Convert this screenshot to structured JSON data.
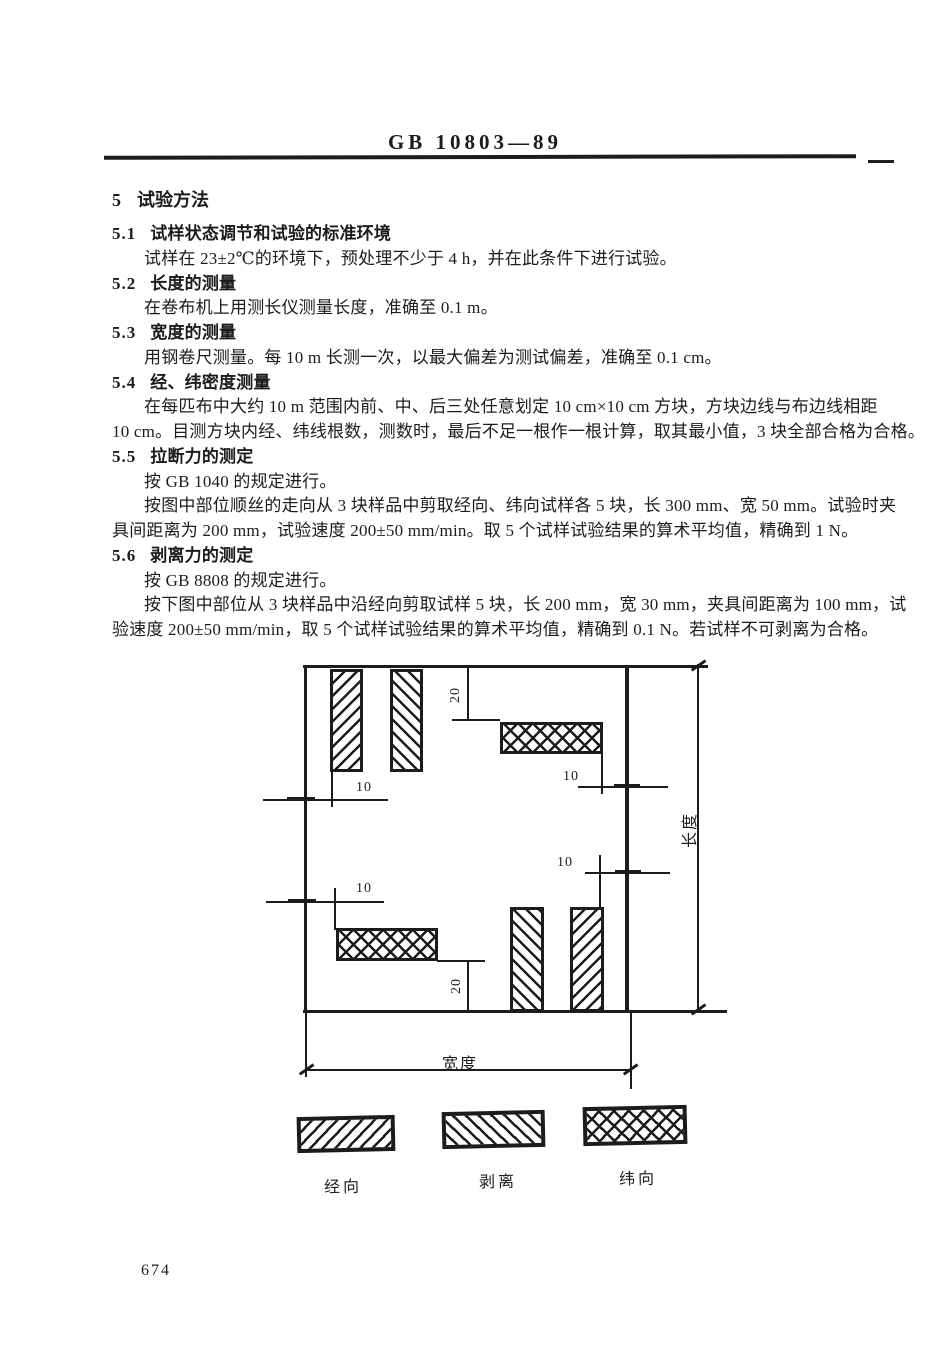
{
  "header": {
    "standard_code": "GB 10803—89"
  },
  "section": {
    "num": "5",
    "title": "试验方法"
  },
  "lines": [
    {
      "type": "clause",
      "num": "5.1",
      "title": "试样状态调节和试验的标准环境"
    },
    {
      "type": "para-first",
      "text": "试样在 23±2℃的环境下，预处理不少于 4 h，并在此条件下进行试验。"
    },
    {
      "type": "clause",
      "num": "5.2",
      "title": "长度的测量"
    },
    {
      "type": "para-first",
      "text": "在卷布机上用测长仪测量长度，准确至 0.1 m。"
    },
    {
      "type": "clause",
      "num": "5.3",
      "title": "宽度的测量"
    },
    {
      "type": "para-first",
      "text": "用钢卷尺测量。每 10 m 长测一次，以最大偏差为测试偏差，准确至 0.1 cm。"
    },
    {
      "type": "clause",
      "num": "5.4",
      "title": "经、纬密度测量"
    },
    {
      "type": "para-first",
      "text": "在每匹布中大约 10 m 范围内前、中、后三处任意划定 10 cm×10 cm 方块，方块边线与布边线相距"
    },
    {
      "type": "para-cont",
      "text": "10 cm。目测方块内经、纬线根数，测数时，最后不足一根作一根计算，取其最小值，3 块全部合格为合格。"
    },
    {
      "type": "clause",
      "num": "5.5",
      "title": "拉断力的测定"
    },
    {
      "type": "para-first",
      "text": "按 GB 1040 的规定进行。"
    },
    {
      "type": "para-first",
      "text": "按图中部位顺丝的走向从 3 块样品中剪取经向、纬向试样各 5 块，长 300 mm、宽 50 mm。试验时夹"
    },
    {
      "type": "para-cont",
      "text": "具间距离为 200 mm，试验速度 200±50 mm/min。取 5 个试样试验结果的算术平均值，精确到 1 N。"
    },
    {
      "type": "clause",
      "num": "5.6",
      "title": "剥离力的测定"
    },
    {
      "type": "para-first",
      "text": "按 GB 8808 的规定进行。"
    },
    {
      "type": "para-first",
      "text": "按下图中部位从 3 块样品中沿经向剪取试样 5 块，长 200 mm，宽 30 mm，夹具间距离为 100 mm，试"
    },
    {
      "type": "para-cont",
      "text": "验速度 200±50 mm/min，取 5 个试样试验结果的算术平均值，精确到 0.1 N。若试样不可剥离为合格。"
    }
  ],
  "figure": {
    "labels": {
      "ten": "10",
      "twenty": "20",
      "length": "长度",
      "width": "宽度"
    },
    "legend": [
      {
        "label": "经向",
        "pattern": "warp-diagonal"
      },
      {
        "label": "剥离",
        "pattern": "peel-diagonal"
      },
      {
        "label": "纬向",
        "pattern": "weft-crosshatch"
      }
    ]
  },
  "footer": {
    "page_number": "674"
  },
  "colors": {
    "ink": "#1c1c1c",
    "paper": "#ffffff"
  }
}
